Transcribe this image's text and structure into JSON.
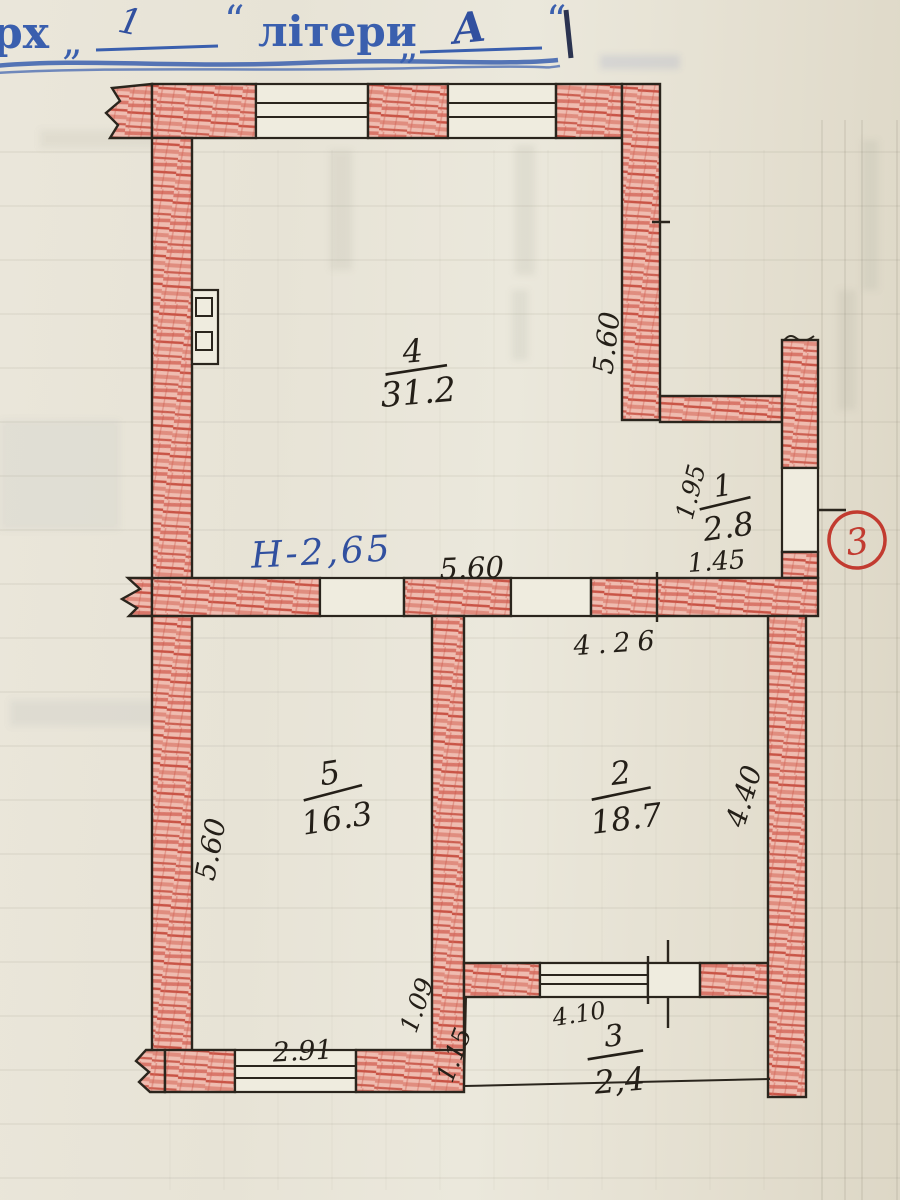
{
  "header": {
    "stub_text": "рх",
    "quote_open_1": "„",
    "floor_value": "1",
    "quote_close_1": "“",
    "letters_label": "літери",
    "quote_open_2": "„",
    "letter_value": "А",
    "quote_close_2": "“"
  },
  "plan": {
    "height_note": "Н-2,65",
    "entrance_number": "3",
    "rooms": {
      "r4": {
        "number": "4",
        "area": "31.2"
      },
      "r1": {
        "number": "1",
        "area": "2.8"
      },
      "r5": {
        "number": "5",
        "area": "16.3"
      },
      "r2": {
        "number": "2",
        "area": "18.7"
      },
      "r3": {
        "number": "3",
        "area": "2,4"
      }
    },
    "dims": {
      "room4_right_wall": "5.60",
      "room4_bottom": "5.60",
      "room1_left": "1.95",
      "room1_bottom": "1.45",
      "room2_top": "4.26",
      "room2_right": "4.40",
      "room5_left_wall": "5.60",
      "room5_step": "1.09",
      "balcony_left": "1.15",
      "balcony_top": "4.10",
      "room5_bottom_window": "2.91"
    },
    "colors": {
      "wall_hatch_red": "#d9776a",
      "ink_blue": "#3a5fae",
      "pencil_black": "#241f18",
      "entrance_red": "#c23b30",
      "paper": "#e8e4d7"
    }
  }
}
